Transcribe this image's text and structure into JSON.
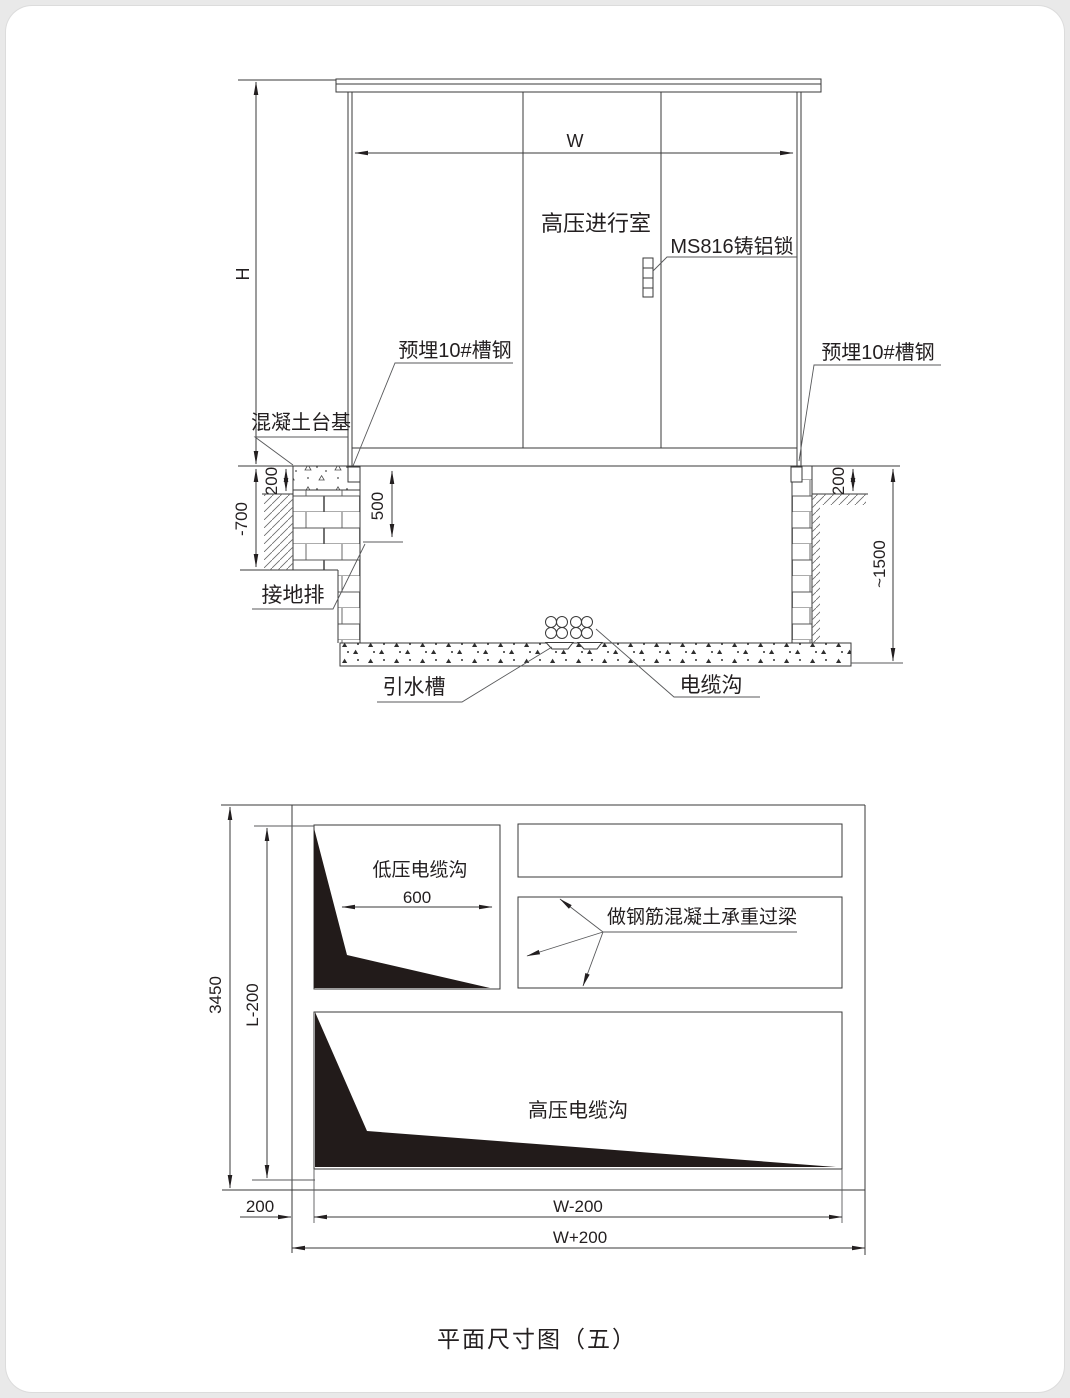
{
  "drawing_title": "平面尺寸图（五）",
  "elevation": {
    "labels": {
      "width_dim": "W",
      "height_dim": "H",
      "hv_room": "高压进行室",
      "lock": "MS816铸铝锁",
      "embedded_channel_left": "预埋10#槽钢",
      "embedded_channel_right": "预埋10#槽钢",
      "concrete_base": "混凝土台基",
      "ground_bar": "接地排",
      "drain_channel": "引水槽",
      "cable_trench": "电缆沟",
      "dim_200_left": "200",
      "dim_minus700": "-700",
      "dim_500": "500",
      "dim_200_right": "200",
      "dim_1500": "~1500"
    }
  },
  "plan": {
    "labels": {
      "lv_trench": "低压电缆沟",
      "dim_600": "600",
      "lintel_note": "做钢筋混凝土承重过梁",
      "hv_trench": "高压电缆沟",
      "dim_3450": "3450",
      "dim_l_minus_200": "L-200",
      "dim_200": "200",
      "dim_w_minus_200": "W-200",
      "dim_w_plus_200": "W+200"
    }
  },
  "colors": {
    "line": "#3a3a3a",
    "fill_black": "#221b1a",
    "background": "#ffffff"
  }
}
